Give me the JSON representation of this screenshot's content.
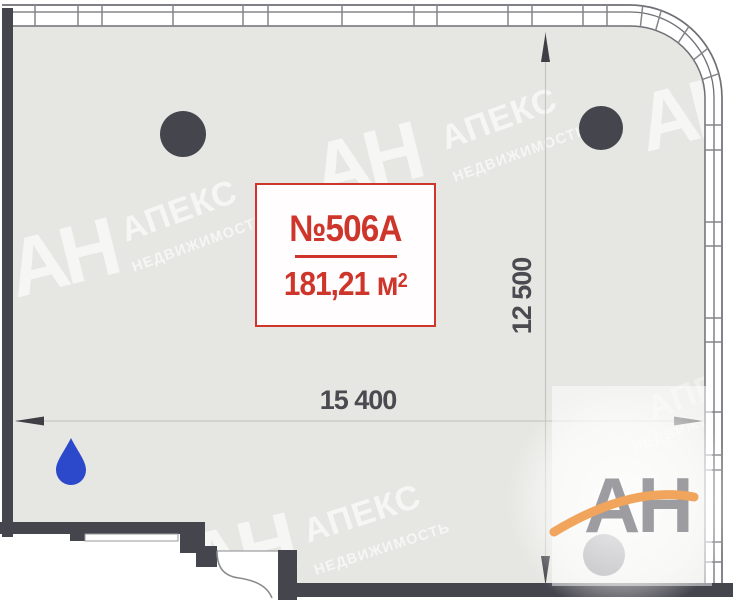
{
  "plan": {
    "unit_label": "№506А",
    "area": {
      "value": "181,21 м",
      "exponent": "2"
    },
    "dimensions": {
      "width_mm": "15 400",
      "depth_mm": "12 500"
    }
  },
  "watermark": {
    "initials": "АН",
    "brand": "АПЕКС",
    "brand_sub": "НЕДВИЖИМОСТЬ"
  },
  "logo": {
    "text": "АН"
  },
  "colors": {
    "accent_red": "#ce362c",
    "wall_dark": "#45454d",
    "floor_fill": "#e6e6e2",
    "water_drop_blue": "#2d49cb",
    "logo_orange": "#f0a45c",
    "logo_gray": "#9d9da1",
    "dimension_text": "#4a4a50"
  },
  "icons": {
    "water_drop": "droplet-shape",
    "column_marker": "filled-circle"
  }
}
